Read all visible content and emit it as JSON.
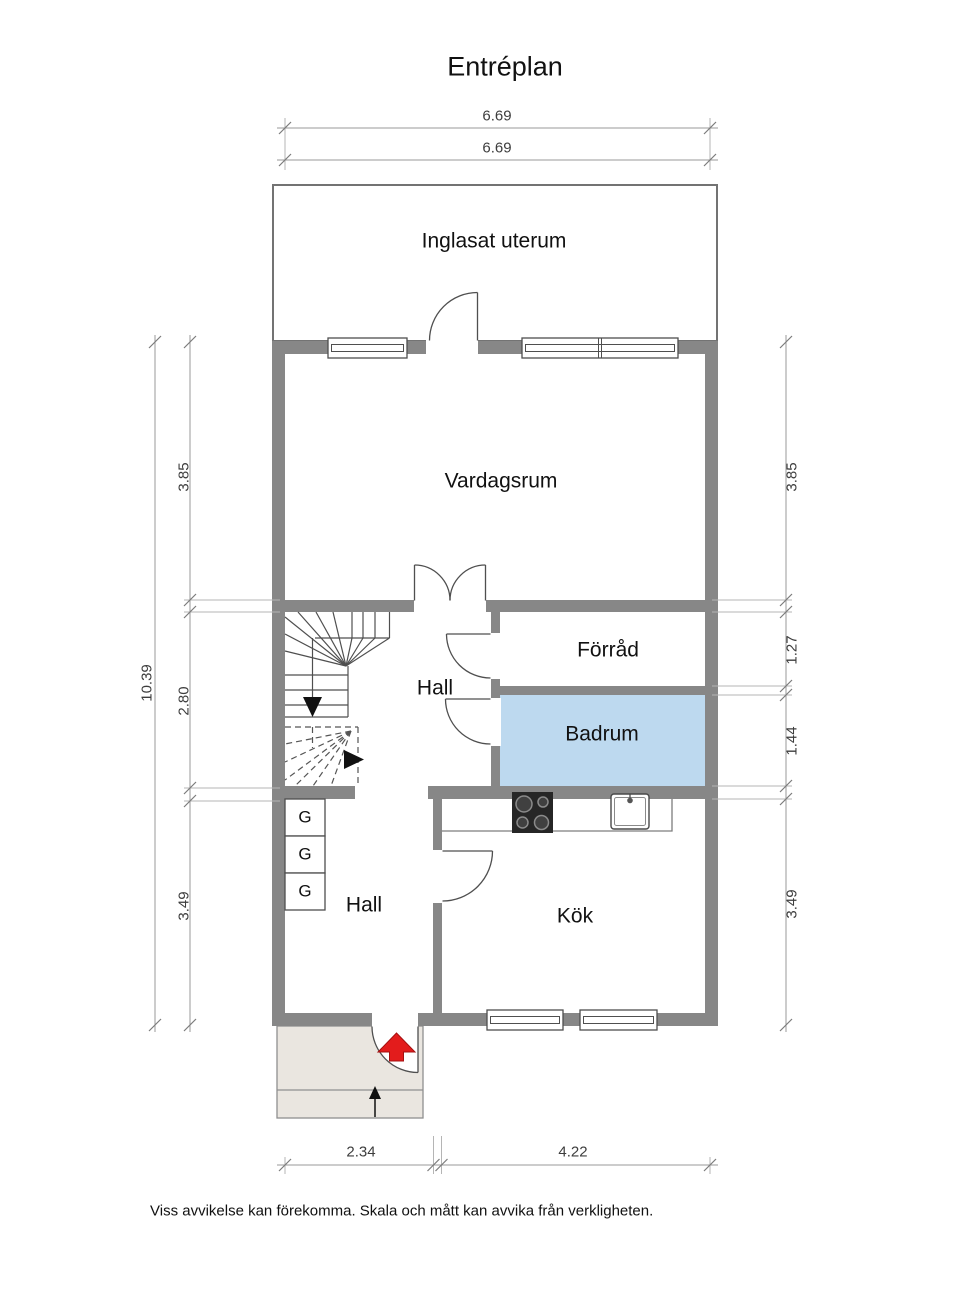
{
  "title": "Entréplan",
  "rooms": {
    "uterum": "Inglasat uterum",
    "vardagsrum": "Vardagsrum",
    "forrad": "Förråd",
    "hall_upper": "Hall",
    "badrum": "Badrum",
    "hall_lower": "Hall",
    "kok": "Kök"
  },
  "wardrobes": [
    "G",
    "G",
    "G"
  ],
  "dimensions": {
    "top": [
      "6.69",
      "6.69"
    ],
    "left_total": "10.39",
    "left": [
      "3.85",
      "2.80",
      "3.49"
    ],
    "right": [
      "3.85",
      "1.27",
      "1.44",
      "3.49"
    ],
    "bottom": [
      "2.34",
      "4.22"
    ]
  },
  "footer": "Viss avvikelse kan förekomma. Skala och mått kan avvika från verkligheten.",
  "colors": {
    "wall": "#878787",
    "badrum": "#bdd9ef",
    "porch": "#eae6e0",
    "entry_arrow": "#e31c1c"
  }
}
